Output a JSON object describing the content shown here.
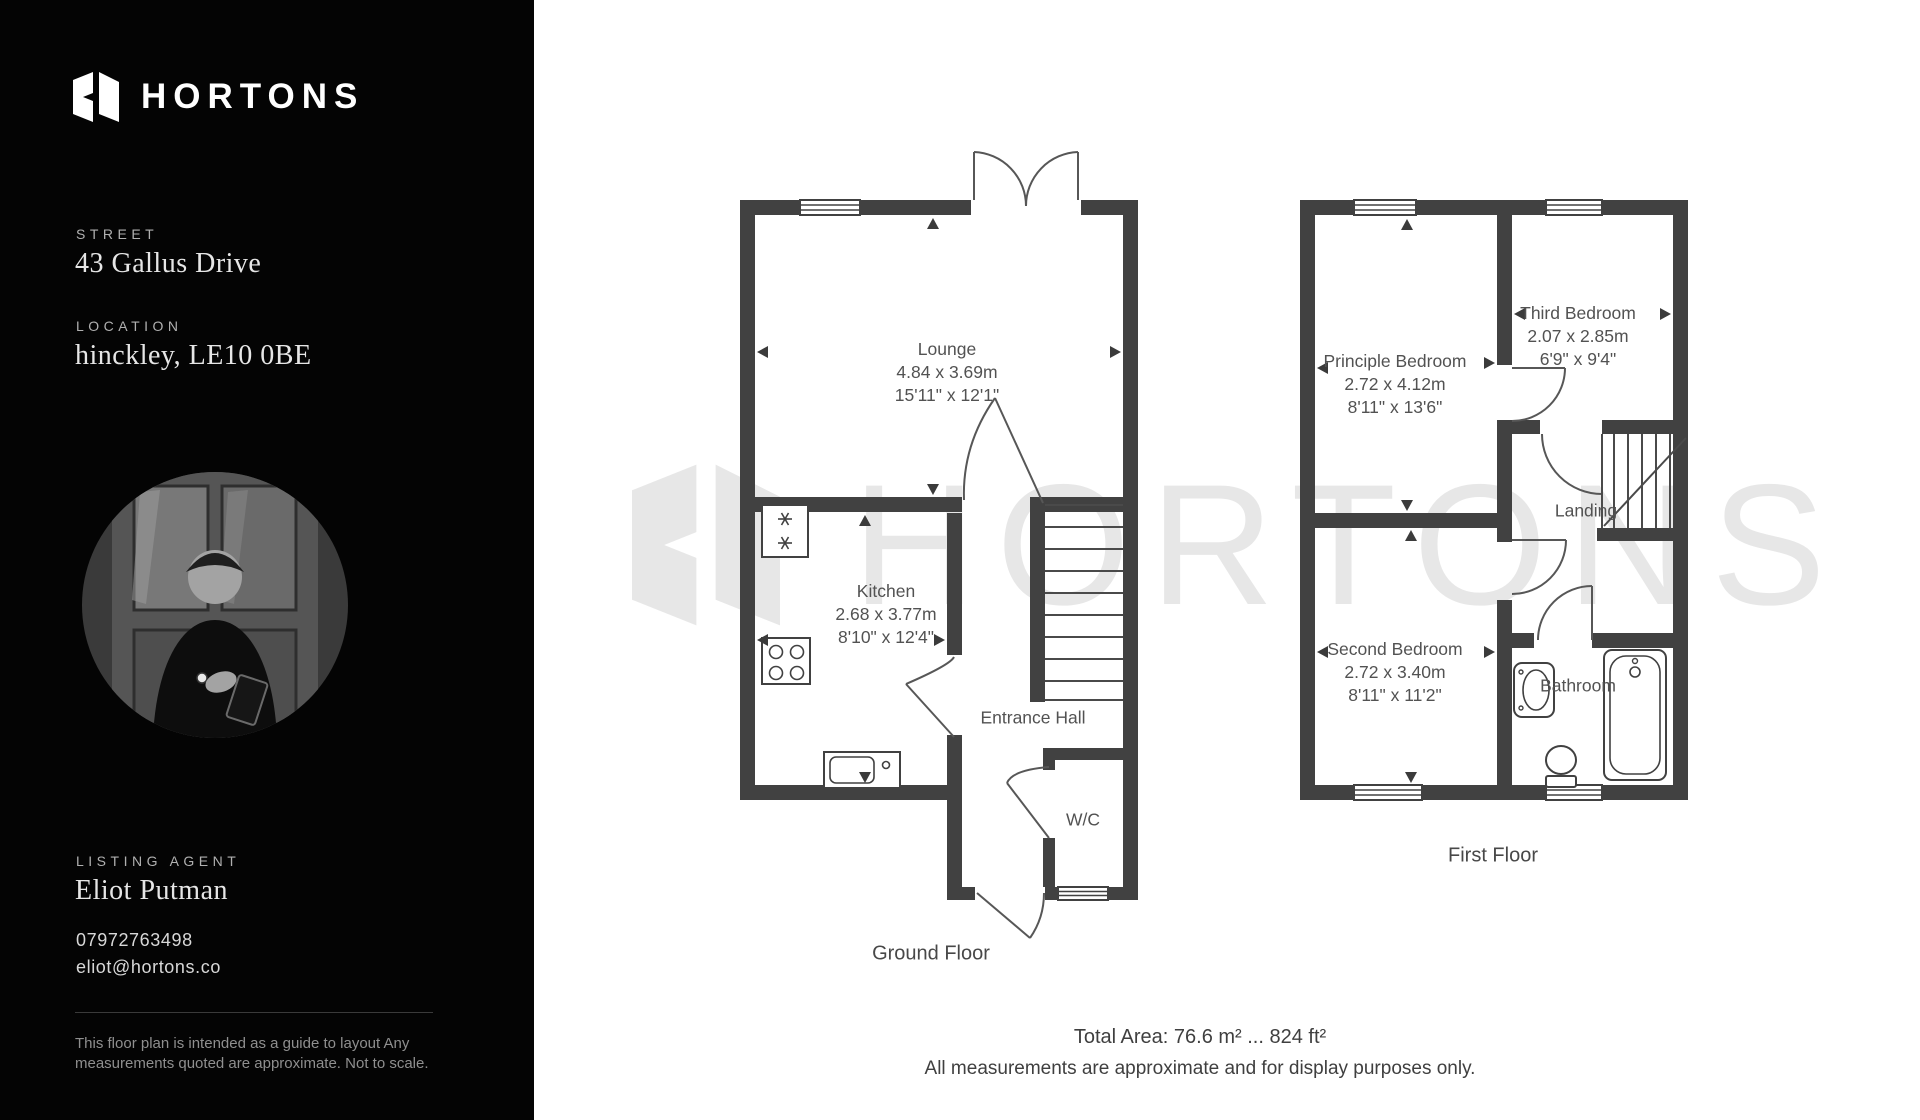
{
  "sidebar": {
    "logo_text": "HORTONS",
    "street": {
      "label": "STREET",
      "value": "43 Gallus Drive"
    },
    "location": {
      "label": "LOCATION",
      "value": "hinckley, LE10 0BE"
    },
    "agent": {
      "label": "LISTING AGENT",
      "name": "Eliot Putman",
      "phone": "07972763498",
      "email": "eliot@hortons.co"
    },
    "disclaimer_line1": "This floor plan is intended  as a guide to layout Any",
    "disclaimer_line2": "measurements quoted are approximate. Not to scale."
  },
  "watermark_text": "HORTONS",
  "ground_floor": {
    "title": "Ground Floor",
    "rooms": {
      "lounge": {
        "name": "Lounge",
        "metric": "4.84 x 3.69m",
        "imperial": "15'11\" x 12'1\""
      },
      "kitchen": {
        "name": "Kitchen",
        "metric": "2.68 x 3.77m",
        "imperial": "8'10\" x 12'4\""
      },
      "entrance_hall": {
        "name": "Entrance Hall"
      },
      "wc": {
        "name": "W/C"
      }
    }
  },
  "first_floor": {
    "title": "First Floor",
    "rooms": {
      "principle_bedroom": {
        "name": "Principle Bedroom",
        "metric": "2.72 x 4.12m",
        "imperial": "8'11\" x 13'6\""
      },
      "third_bedroom": {
        "name": "Third Bedroom",
        "metric": "2.07 x 2.85m",
        "imperial": "6'9\" x 9'4\""
      },
      "second_bedroom": {
        "name": "Second Bedroom",
        "metric": "2.72 x 3.40m",
        "imperial": "8'11\" x 11'2\""
      },
      "landing": {
        "name": "Landing"
      },
      "bathroom": {
        "name": "Bathroom"
      }
    }
  },
  "footer": {
    "total_area": "Total Area: 76.6 m² ... 824 ft²",
    "note": "All measurements are approximate and for display purposes only."
  },
  "plan_icons": [
    "fridge-freezer",
    "hob",
    "kitchen-sink",
    "stairs",
    "bathtub",
    "toilet",
    "basin",
    "door-swing",
    "window",
    "measure-arrow"
  ],
  "colors": {
    "sidebar_bg": "#040404",
    "wall": "#414141",
    "watermark": "#e7e7e7",
    "label_text": "#525252"
  }
}
